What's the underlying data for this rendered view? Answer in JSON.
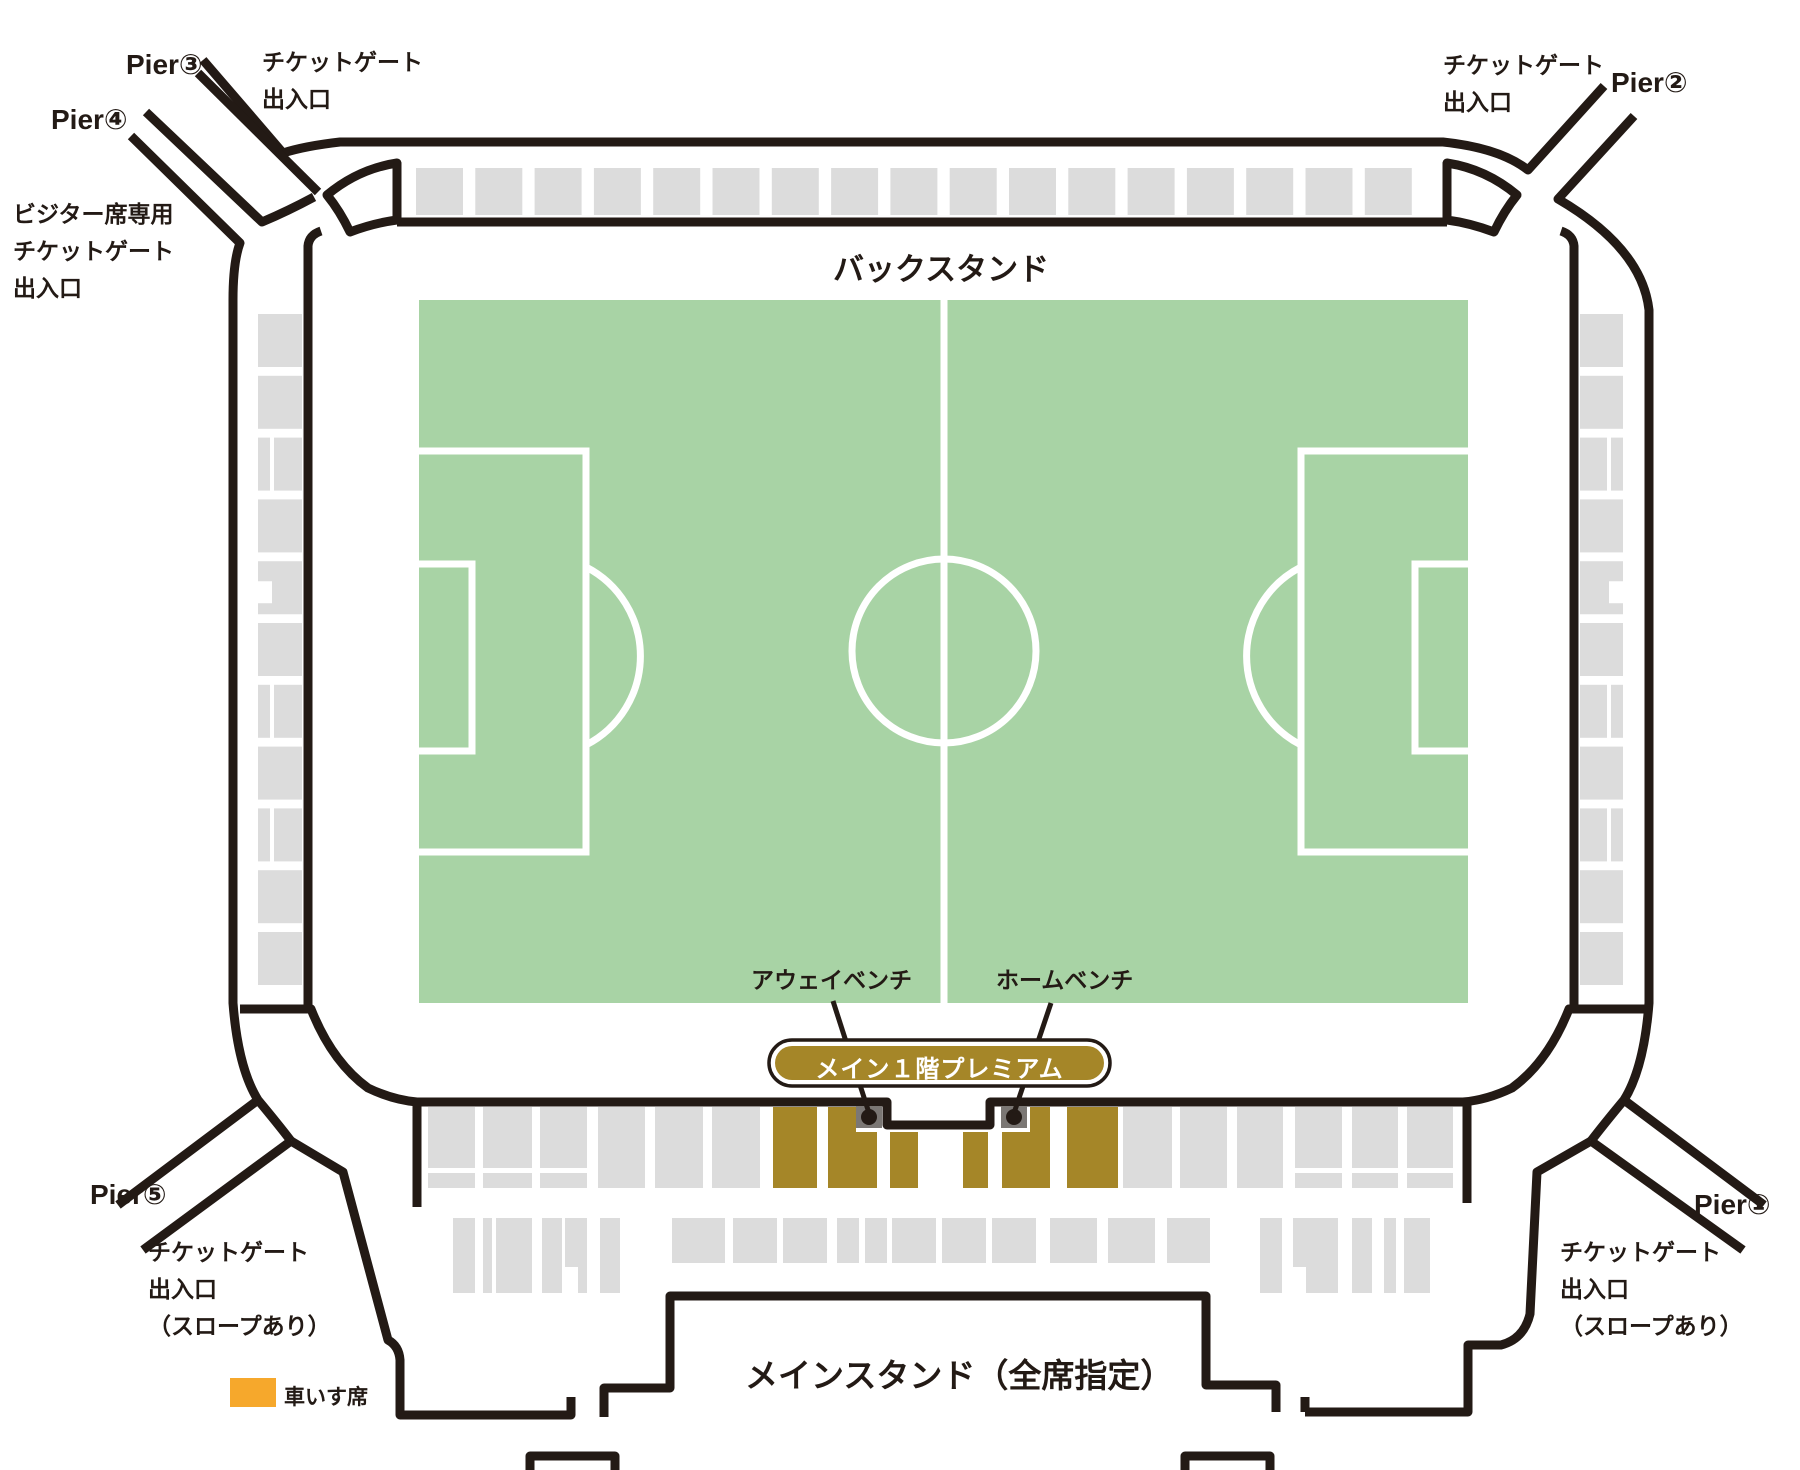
{
  "colors": {
    "line": "#231a15",
    "seat_gray": "#dcdcdc",
    "pitch_green": "#a8d3a5",
    "premium_gold": "#a58628",
    "bench_gray": "#7b7774",
    "wheelchair_orange": "#f6a82c",
    "pitch_line_white": "#ffffff"
  },
  "labels": {
    "back_stand": "バックスタンド",
    "main_stand": "メインスタンド（全席指定）",
    "premium_badge": "メイン１階プレミアム",
    "away_bench": "アウェイベンチ",
    "home_bench": "ホームベンチ",
    "wheelchair_legend": "車いす席",
    "pier1": "Pier①",
    "pier2": "Pier②",
    "pier3": "Pier③",
    "pier4": "Pier④",
    "pier5": "Pier⑤",
    "gate_nw": {
      "line1": "チケットゲート",
      "line2": "出入口"
    },
    "gate_ne": {
      "line1": "チケットゲート",
      "line2": "出入口"
    },
    "visitor_gate": {
      "line1": "ビジター席専用",
      "line2": "チケットゲート",
      "line3": "出入口"
    },
    "gate_sw": {
      "line1": "チケットゲート",
      "line2": "出入口",
      "line3": "（スロープあり）"
    },
    "gate_se": {
      "line1": "チケットゲート",
      "line2": "出入口",
      "line3": "（スロープあり）"
    }
  },
  "seat_blocks": {
    "top_row": {
      "x": 416,
      "y": 168,
      "w": 47,
      "h": 47,
      "pitch": 59.3,
      "count": 17
    },
    "left_column": {
      "x": 258,
      "w": 44,
      "y": 314,
      "h": 53,
      "pitch": 61.8,
      "types": [
        "full",
        "full",
        "vsplit",
        "full",
        "notch",
        "full",
        "vsplit",
        "full",
        "vsplit",
        "full",
        "full"
      ]
    },
    "right_column": {
      "x": 1580,
      "w": 43,
      "y": 314,
      "h": 53,
      "pitch": 61.8,
      "types": [
        "full",
        "full",
        "vsplit",
        "full",
        "notch",
        "full",
        "vsplit",
        "full",
        "vsplit",
        "full",
        "full"
      ]
    },
    "main_row1": {
      "y": 1107,
      "h": 81,
      "blocks": [
        {
          "x": 428,
          "w": 47,
          "c": "gray",
          "t": "hsplit"
        },
        {
          "x": 483,
          "w": 49,
          "c": "gray",
          "t": "hsplit"
        },
        {
          "x": 540,
          "w": 47,
          "c": "gray",
          "t": "hsplit"
        },
        {
          "x": 598,
          "w": 47,
          "c": "gray",
          "t": "full"
        },
        {
          "x": 655,
          "w": 48,
          "c": "gray",
          "t": "full"
        },
        {
          "x": 712,
          "w": 48,
          "c": "gray",
          "t": "full"
        },
        {
          "x": 773,
          "w": 44,
          "c": "gold",
          "t": "full"
        },
        {
          "x": 828,
          "w": 49,
          "c": "gold",
          "t": "LR"
        },
        {
          "x": 890,
          "w": 28,
          "c": "gold",
          "t": "low"
        },
        {
          "x": 963,
          "w": 25,
          "c": "gold",
          "t": "low"
        },
        {
          "x": 1002,
          "w": 48,
          "c": "gold",
          "t": "LL"
        },
        {
          "x": 1067,
          "w": 51,
          "c": "gold",
          "t": "full"
        },
        {
          "x": 1123,
          "w": 49,
          "c": "gray",
          "t": "full"
        },
        {
          "x": 1180,
          "w": 47,
          "c": "gray",
          "t": "full"
        },
        {
          "x": 1237,
          "w": 46,
          "c": "gray",
          "t": "full"
        },
        {
          "x": 1295,
          "w": 47,
          "c": "gray",
          "t": "hsplit"
        },
        {
          "x": 1352,
          "w": 46,
          "c": "gray",
          "t": "hsplit"
        },
        {
          "x": 1407,
          "w": 46,
          "c": "gray",
          "t": "hsplit"
        }
      ]
    },
    "main_row2": {
      "y": 1218,
      "tall_h": 75,
      "short_h": 45,
      "blocks": [
        {
          "x": 453,
          "w": 22,
          "t": "tall"
        },
        {
          "x": 483,
          "w": 9,
          "t": "tall"
        },
        {
          "x": 496,
          "w": 36,
          "t": "tall"
        },
        {
          "x": 542,
          "w": 20,
          "t": "tall"
        },
        {
          "x": 565,
          "w": 22,
          "t": "tallnotch"
        },
        {
          "x": 600,
          "w": 20,
          "t": "tall"
        },
        {
          "x": 672,
          "w": 53,
          "t": "short"
        },
        {
          "x": 733,
          "w": 44,
          "t": "short"
        },
        {
          "x": 783,
          "w": 44,
          "t": "short"
        },
        {
          "x": 837,
          "w": 22,
          "t": "short"
        },
        {
          "x": 865,
          "w": 22,
          "t": "short"
        },
        {
          "x": 892,
          "w": 44,
          "t": "short"
        },
        {
          "x": 942,
          "w": 44,
          "t": "short"
        },
        {
          "x": 992,
          "w": 44,
          "t": "short"
        },
        {
          "x": 1050,
          "w": 47,
          "t": "short"
        },
        {
          "x": 1108,
          "w": 47,
          "t": "short"
        },
        {
          "x": 1167,
          "w": 43,
          "t": "short"
        },
        {
          "x": 1260,
          "w": 22,
          "t": "tall"
        },
        {
          "x": 1293,
          "w": 45,
          "t": "tallnotch"
        },
        {
          "x": 1352,
          "w": 20,
          "t": "tall"
        },
        {
          "x": 1384,
          "w": 12,
          "t": "tall"
        },
        {
          "x": 1404,
          "w": 26,
          "t": "tall"
        }
      ]
    },
    "benches": [
      {
        "x": 856,
        "y": 1106,
        "w": 26,
        "h": 22
      },
      {
        "x": 1001,
        "y": 1106,
        "w": 26,
        "h": 22
      }
    ]
  }
}
